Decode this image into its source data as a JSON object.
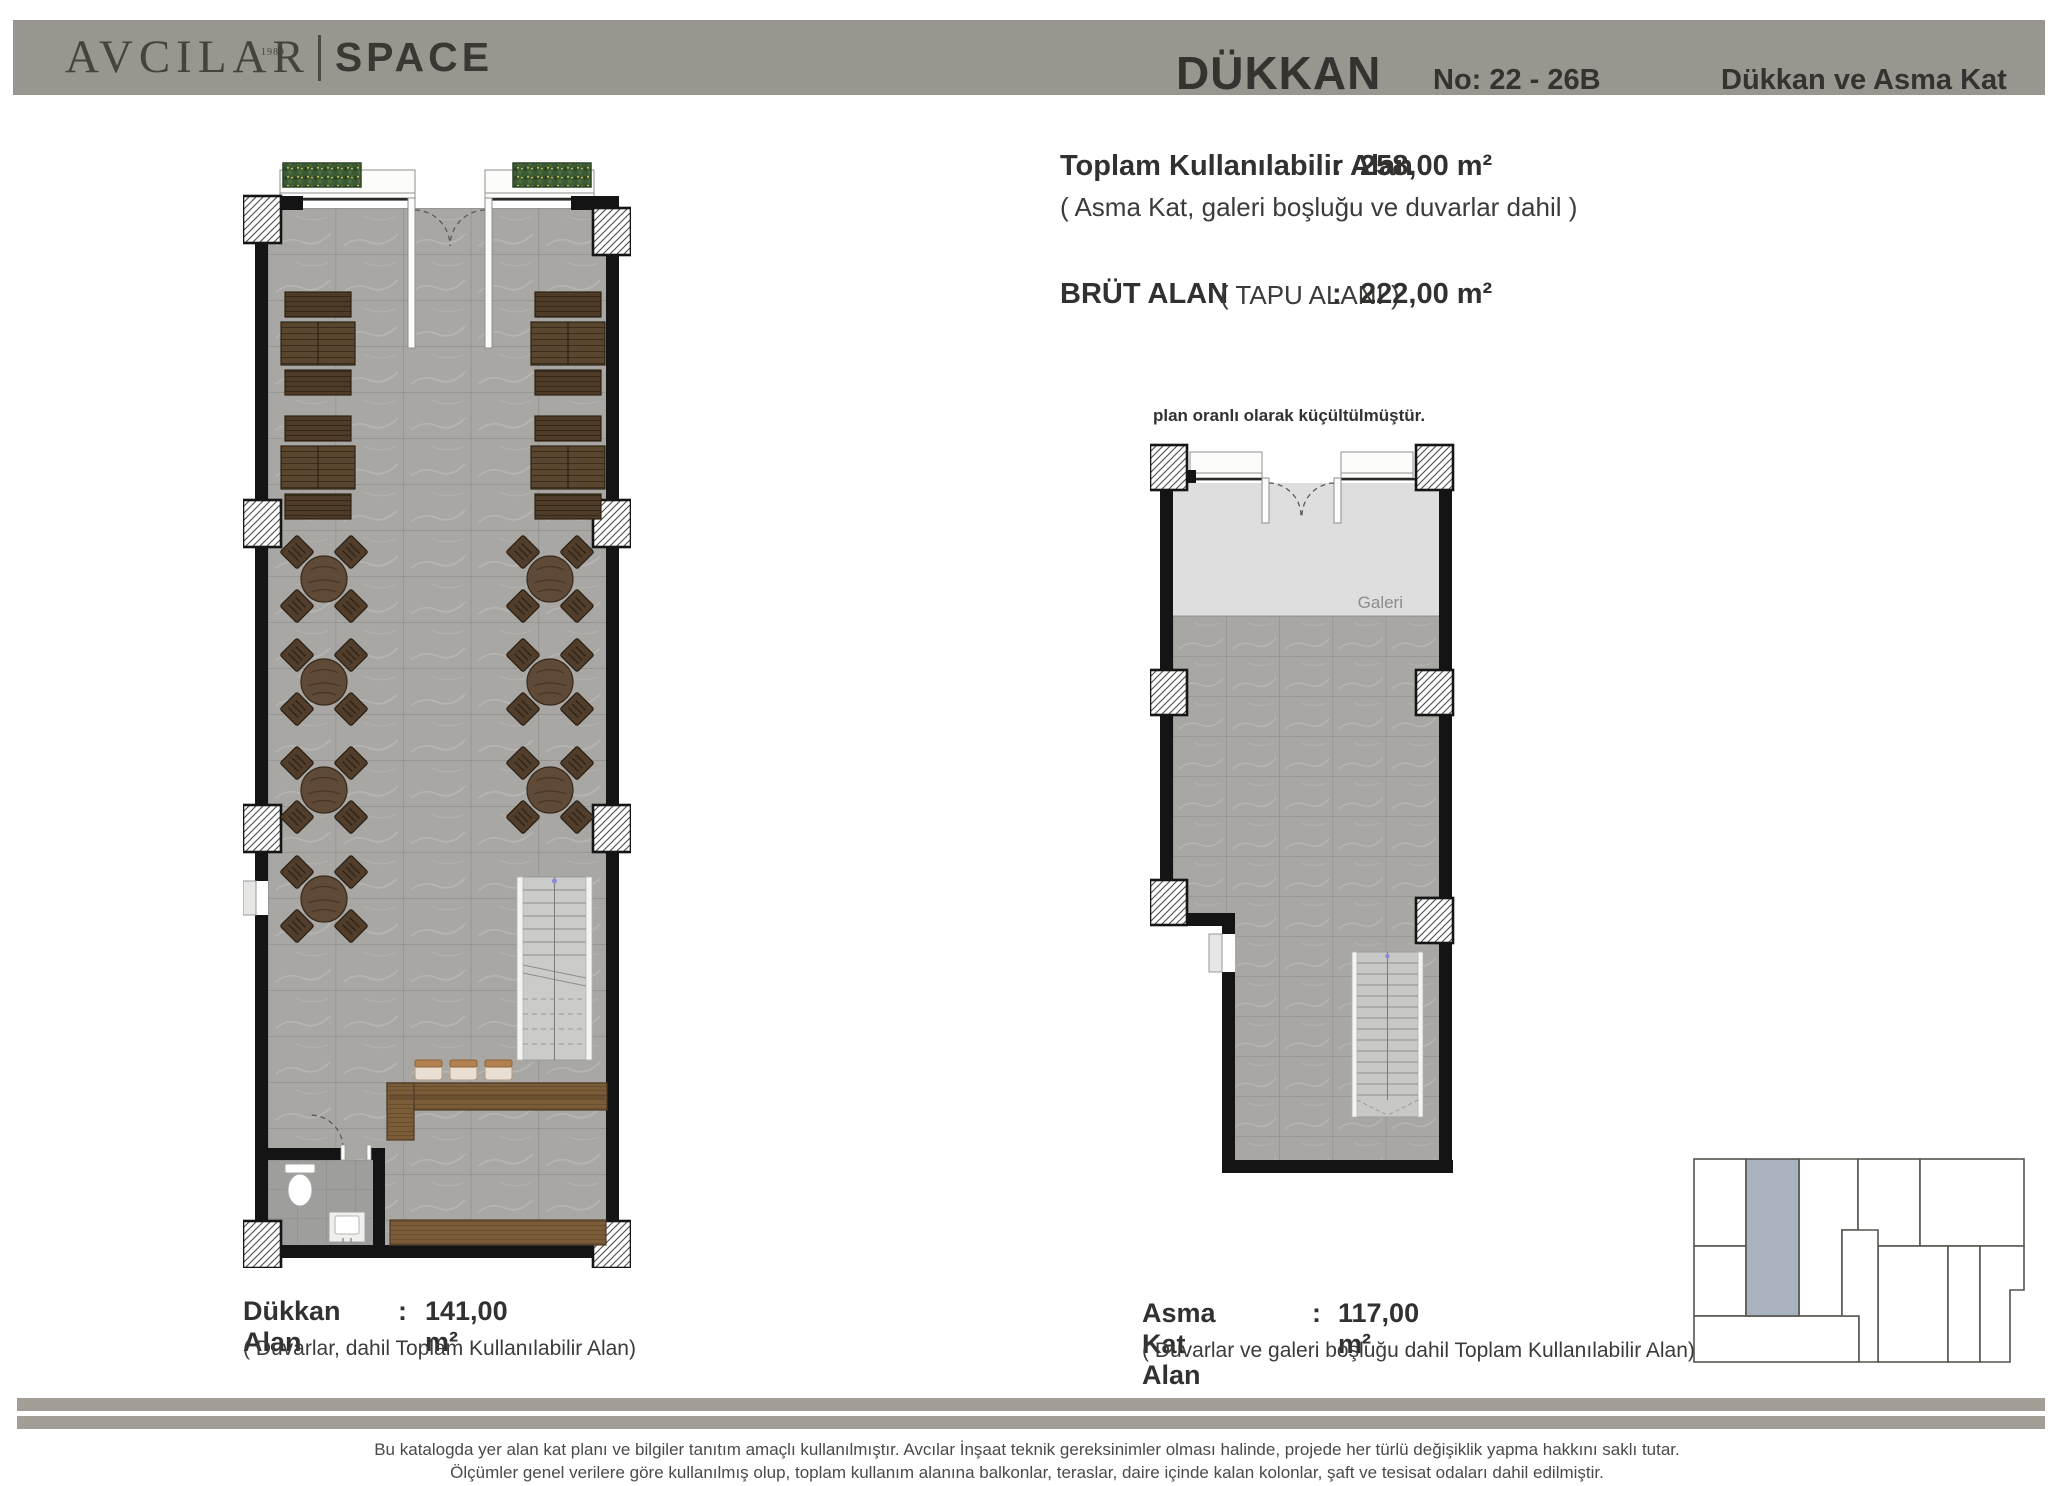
{
  "header": {
    "logo": {
      "brand": "AVCILAR",
      "year": "1989",
      "name": "SPACE"
    },
    "title": "DÜKKAN",
    "unit_no": "No: 22 - 26B",
    "subtitle": "Dükkan ve Asma Kat"
  },
  "areas": {
    "total_label": "Toplam Kullanılabilir Alan",
    "total_sep": ":",
    "total_value": "258,00 m²",
    "total_note": "( Asma Kat, galeri boşluğu ve duvarlar dahil  )",
    "gross_label": "BRÜT  ALAN",
    "gross_sub": "( TAPU ALANI )",
    "gross_sep": ":",
    "gross_value": "222,00 m²"
  },
  "scale_note": "plan oranlı olarak küçültülmüştür.",
  "plans": {
    "dukkan": {
      "label": "Dükkan Alan",
      "sep": ":",
      "value": "141,00 m²",
      "note": "( Duvarlar, dahil Toplam Kullanılabilir Alan)"
    },
    "asma_kat": {
      "label": "Asma Kat Alan",
      "sep": ":",
      "value": "117,00 m²",
      "note": "( Duvarlar ve galeri boşluğu dahil Toplam Kullanılabilir Alan)",
      "gallery_label": "Galeri"
    }
  },
  "footer": {
    "line1": "Bu katalogda yer alan kat planı ve bilgiler tanıtım amaçlı kullanılmıştır. Avcılar İnşaat teknik gereksinimler olması halinde, projede her türlü değişiklik yapma hakkını saklı tutar.",
    "line2": "Ölçümler genel verilere göre kullanılmış olup, toplam kullanım alanına balkonlar, teraslar, daire içinde kalan kolonlar, şaft ve tesisat odaları dahil edilmiştir."
  },
  "colors": {
    "header_bar": "#99968f",
    "footer_bar": "#a29e96",
    "highlight_unit": "#a9b2bf",
    "wall": "#141414",
    "floor_tile": "#a9a7a4",
    "gallery": "#dedede",
    "wood": "#7b5c39"
  }
}
